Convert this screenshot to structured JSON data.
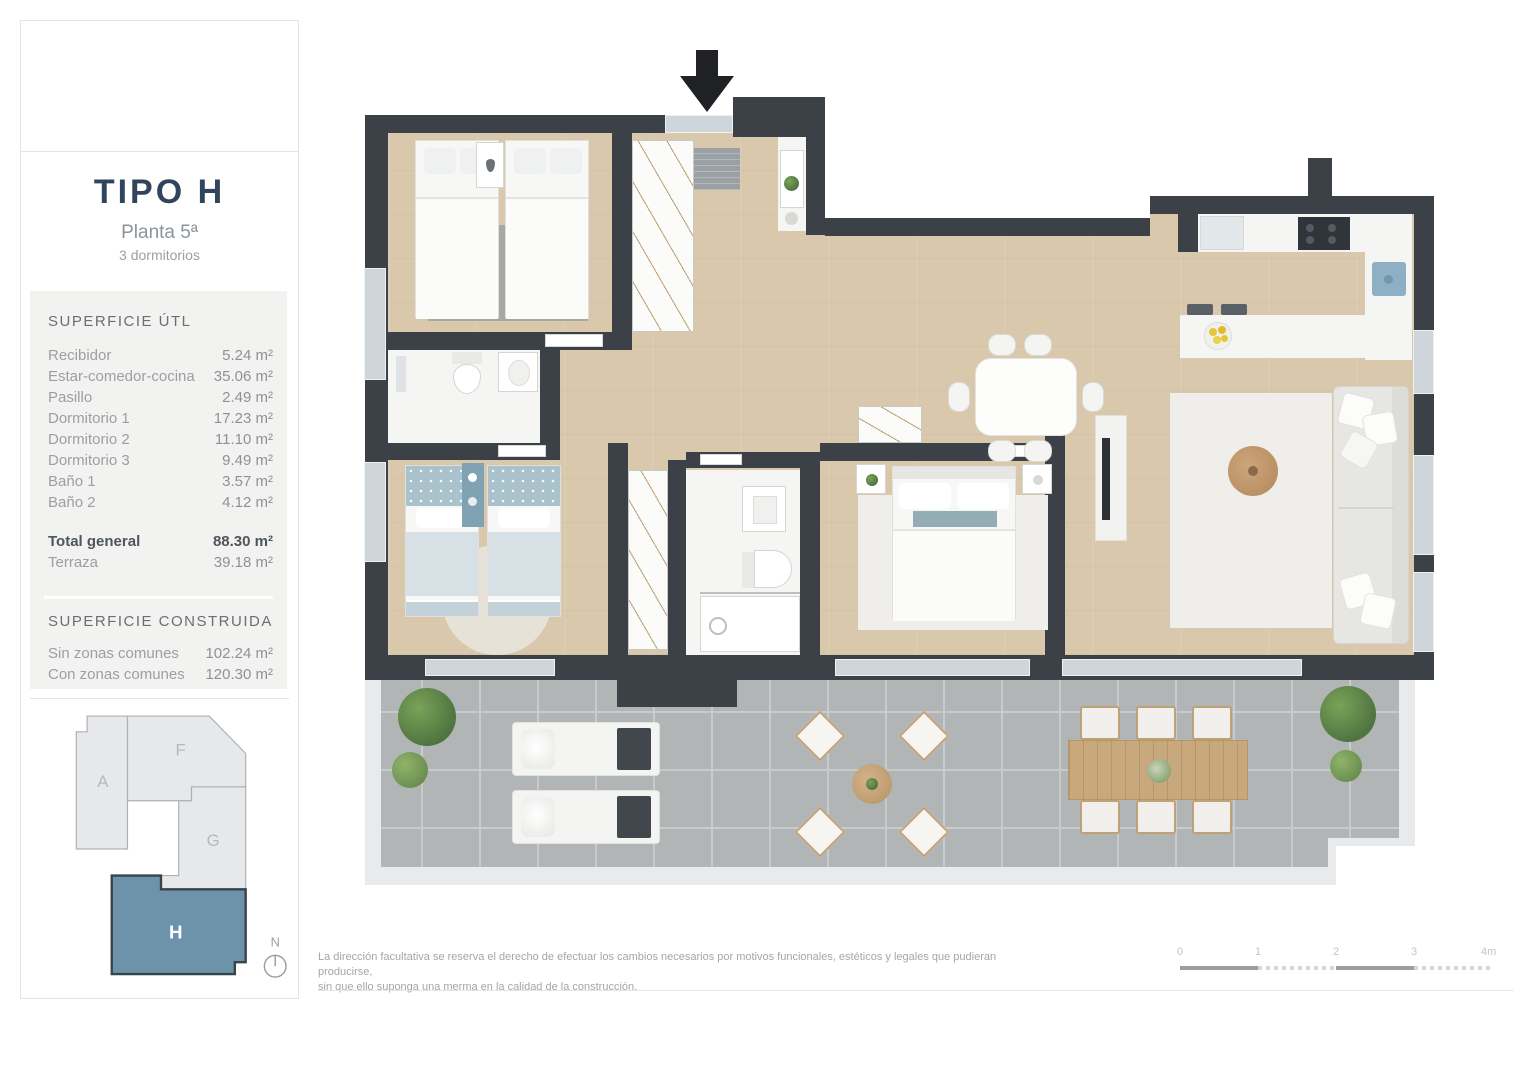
{
  "panel": {
    "title": "TIPO H",
    "subtitle": "Planta 5ª",
    "subtitle2": "3 dormitorios",
    "superficie_util": {
      "heading": "SUPERFICIE ÚTL",
      "rows": [
        {
          "label": "Recibidor",
          "value": "5.24 m²"
        },
        {
          "label": "Estar-comedor-cocina",
          "value": "35.06 m²"
        },
        {
          "label": "Pasillo",
          "value": "2.49 m²"
        },
        {
          "label": "Dormitorio 1",
          "value": "17.23 m²"
        },
        {
          "label": "Dormitorio 2",
          "value": "11.10 m²"
        },
        {
          "label": "Dormitorio 3",
          "value": "9.49 m²"
        },
        {
          "label": "Baño 1",
          "value": "3.57 m²"
        },
        {
          "label": "Baño 2",
          "value": "4.12 m²"
        }
      ],
      "total": {
        "label": "Total general",
        "value": "88.30 m²"
      },
      "terraza": {
        "label": "Terraza",
        "value": "39.18 m²"
      }
    },
    "superficie_construida": {
      "heading": "SUPERFICIE CONSTRUIDA",
      "rows": [
        {
          "label": "Sin zonas comunes",
          "value": "102.24 m²"
        },
        {
          "label": "Con zonas comunes",
          "value": "120.30 m²"
        }
      ]
    },
    "keyplan": {
      "blocks": [
        {
          "id": "A",
          "highlighted": false
        },
        {
          "id": "F",
          "highlighted": false
        },
        {
          "id": "G",
          "highlighted": false
        },
        {
          "id": "H",
          "highlighted": true
        }
      ],
      "highlight_color": "#6d93aa",
      "north_label": "N"
    }
  },
  "footer": {
    "disclaimer_line1": "La dirección facultativa se reserva el derecho de efectuar los cambios necesarios por motivos funcionales, estéticos y legales que pudieran producirse,",
    "disclaimer_line2": "sin que ello suponga una merma en la calidad de la construcción.",
    "scale": {
      "labels": [
        "0",
        "1",
        "2",
        "3",
        "4m"
      ]
    }
  },
  "colors": {
    "wall": "#3b4147",
    "wood_floor": "#d9c8ac",
    "terrace_tile": "#b2b5b6",
    "accent_block_h": "#6d93aa",
    "title_text": "#30455c"
  },
  "icons": {
    "entry_arrow": "black downward arrow at apartment entrance",
    "north_compass": "circle with upward needle"
  }
}
